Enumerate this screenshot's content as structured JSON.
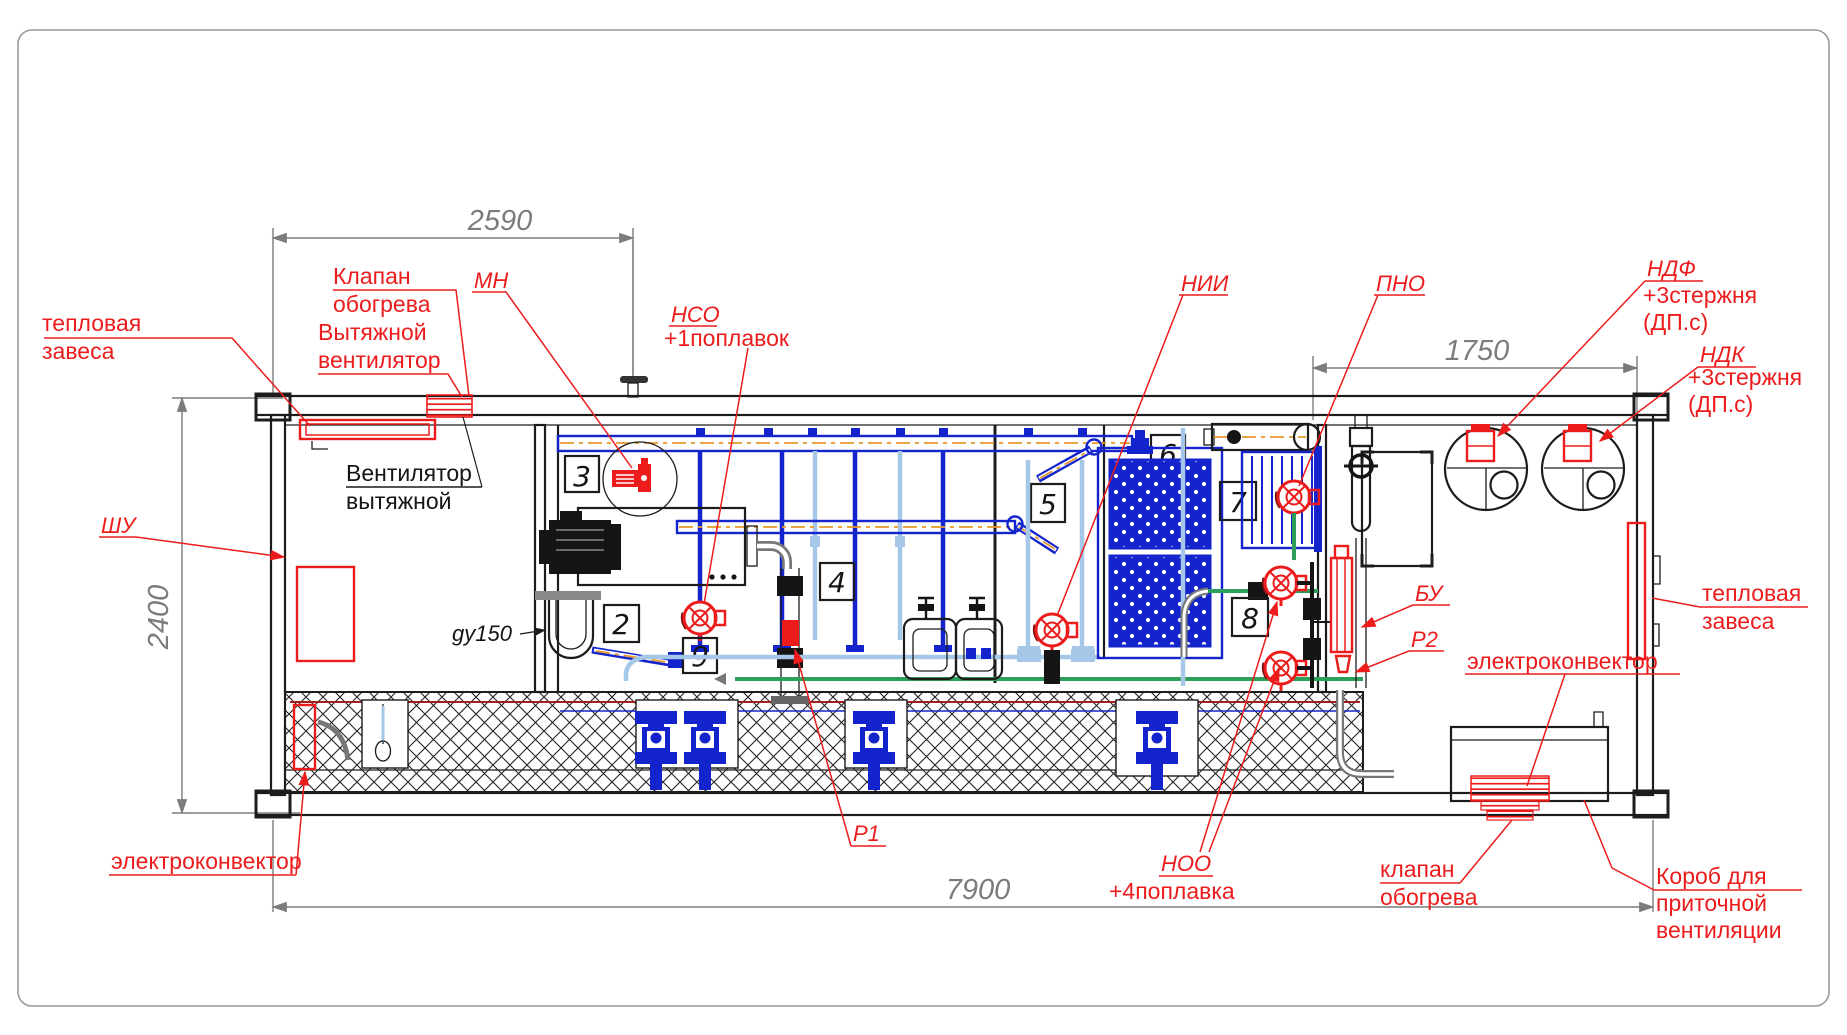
{
  "dims": {
    "top": "2590",
    "right": "1750",
    "length": "7900",
    "height": "2400"
  },
  "tags": {
    "t2": "2",
    "t3": "3",
    "t4": "4",
    "t5": "5",
    "t6": "6",
    "t7": "7",
    "t8": "8",
    "t9": "9"
  },
  "labels": {
    "thermal_curtain_left": {
      "line1": "тепловая",
      "line2": "завеса"
    },
    "heating_valve_top": {
      "line1": "Клапан",
      "line2": "обогрева"
    },
    "exhaust_fan_top": {
      "line1": "Вытяжной",
      "line2": "вентилятор"
    },
    "mn": "МН",
    "nso": {
      "code": "НСО",
      "note": "+1поплавок"
    },
    "nii": "НИИ",
    "pno": "ПНО",
    "ndf": {
      "code": "НДФ",
      "note1": "+3стержня",
      "note2": "(ДП.с)"
    },
    "ndk": {
      "code": "НДК",
      "note1": "+3стержня",
      "note2": "(ДП.с)"
    },
    "shu": "ШУ",
    "exhaust_fan_black": {
      "line1": "Вентилятор",
      "line2": "вытяжной"
    },
    "gy150": "gy150",
    "bu": "БУ",
    "r2": "Р2",
    "r1": "Р1",
    "thermal_curtain_right": {
      "line1": "тепловая",
      "line2": "завеса"
    },
    "electroconvector_right": "электроконвектор",
    "electroconvector_left": "электроконвектор",
    "noo": {
      "code": "НОО",
      "note": "+4поплавка"
    },
    "heating_valve_bottom": {
      "line1": "клапан",
      "line2": "обогрева"
    },
    "supply_duct": {
      "line1": "Короб для",
      "line2": "приточной",
      "line3": "вентиляции"
    }
  },
  "colors": {
    "callout_red": "#ec1c1c",
    "pipe_blue": "#1324cc",
    "pipe_light_blue": "#a6c8e8",
    "pipe_green": "#2ca05a",
    "pipe_orange": "#e8982c",
    "dimension_gray": "#7c7c7c",
    "line_black": "#1c1c1c"
  }
}
